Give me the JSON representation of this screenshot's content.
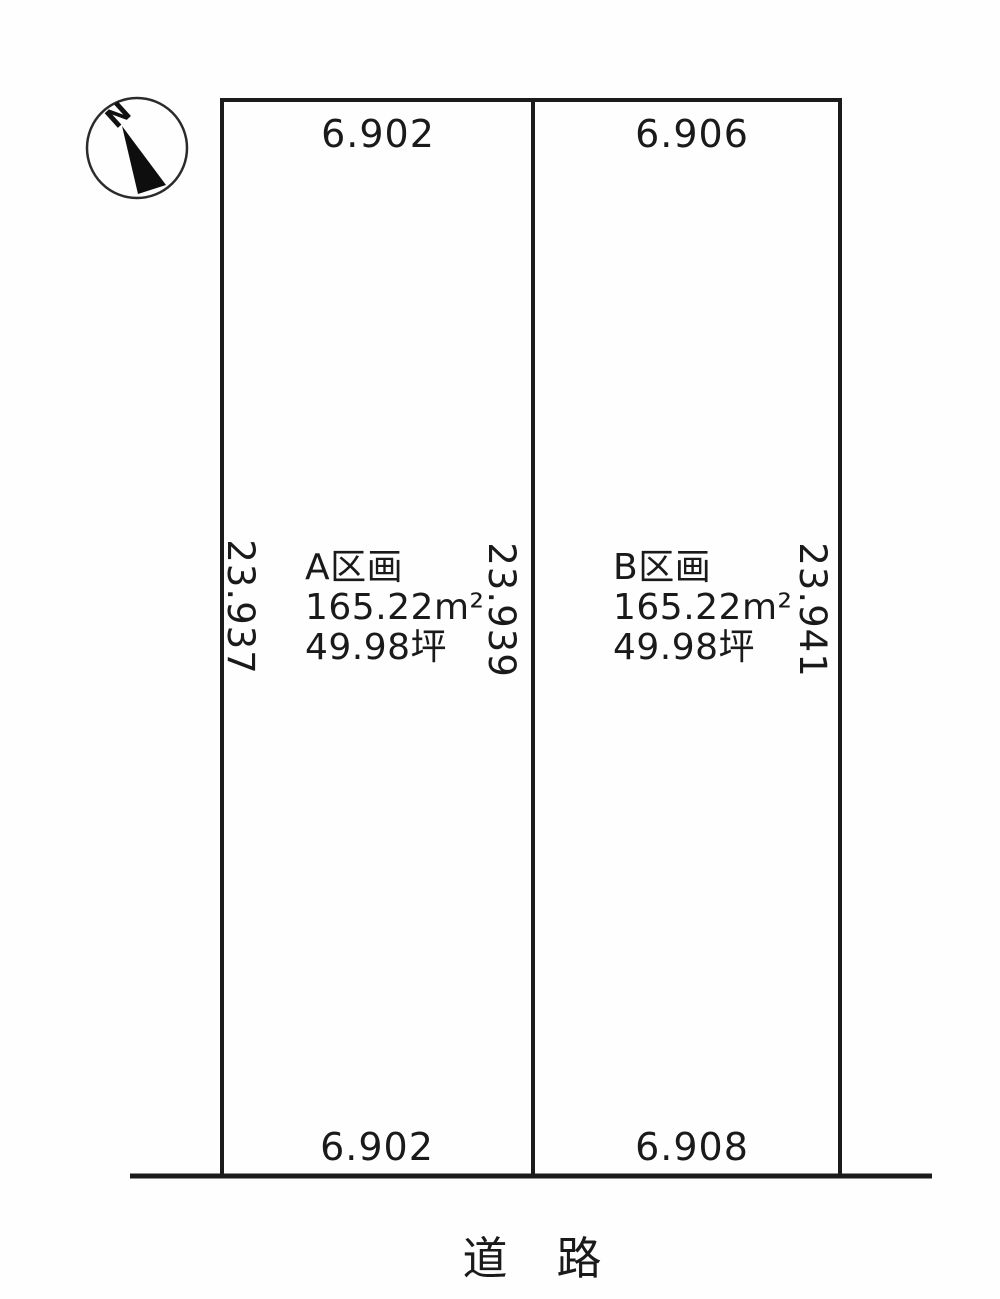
{
  "diagram_title": "land-plot-layout",
  "compass": {
    "north_label": "N"
  },
  "plots": {
    "a": {
      "name": "A区画",
      "area_sqm": "165.22m²",
      "area_tsubo": "49.98坪",
      "top_dim": "6.902",
      "bottom_dim": "6.902"
    },
    "b": {
      "name": "B区画",
      "area_sqm": "165.22m²",
      "area_tsubo": "49.98坪",
      "top_dim": "6.906",
      "bottom_dim": "6.908"
    }
  },
  "side_dims": {
    "left": "23.937",
    "middle": "23.939",
    "right": "23.941"
  },
  "road": {
    "label": "道　路"
  },
  "colors": {
    "line": "#1b1b1b",
    "text": "#1a1a1a",
    "background": "#fefefe"
  }
}
